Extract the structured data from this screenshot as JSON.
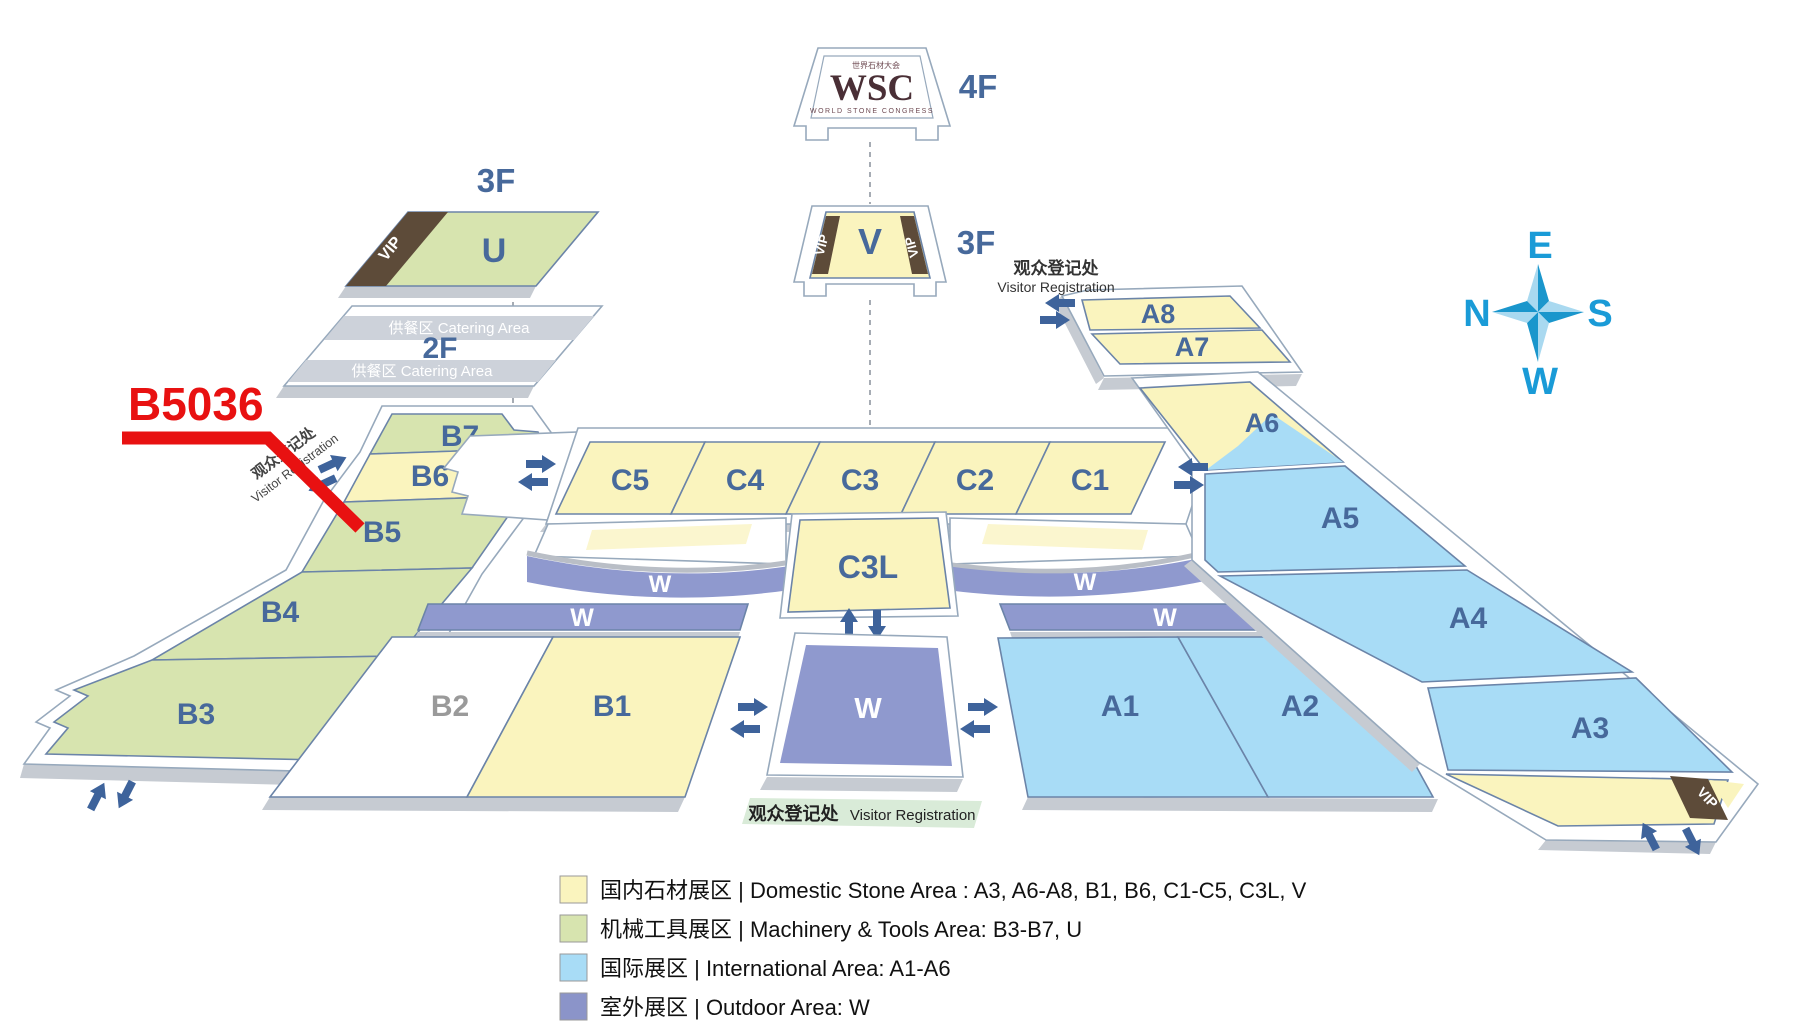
{
  "annotation": {
    "booth_label": "B5036"
  },
  "buildings": {
    "wsc": {
      "floor": "4F",
      "logo_cn": "世界石材大会",
      "logo_main": "WSC",
      "logo_sub": "WORLD STONE CONGRESS"
    },
    "v": {
      "floor": "3F"
    },
    "u": {
      "floor": "3F"
    },
    "f2": {
      "floor": "2F",
      "catering": "供餐区  Catering Area"
    }
  },
  "halls": {
    "a1": "A1",
    "a2": "A2",
    "a3": "A3",
    "a4": "A4",
    "a5": "A5",
    "a6": "A6",
    "a7": "A7",
    "a8": "A8",
    "b1": "B1",
    "b2": "B2",
    "b3": "B3",
    "b4": "B4",
    "b5": "B5",
    "b6": "B6",
    "b7": "B7",
    "c1": "C1",
    "c2": "C2",
    "c3": "C3",
    "c4": "C4",
    "c5": "C5",
    "c3l": "C3L",
    "u": "U",
    "v": "V",
    "w": "W",
    "vip": "VIP"
  },
  "registration": {
    "cn": "观众登记处",
    "en": "Visitor Registration"
  },
  "compass": {
    "top": "E",
    "left": "N",
    "right": "S",
    "bottom": "W"
  },
  "legend": {
    "items": [
      {
        "swatch": "#FAF4BE",
        "label": "国内石材展区 | Domestic Stone Area : A3, A6-A8, B1, B6, C1-C5, C3L, V"
      },
      {
        "swatch": "#D7E4AF",
        "label": "机械工具展区 | Machinery & Tools Area: B3-B7, U"
      },
      {
        "swatch": "#A8DCF6",
        "label": "国际展区 | International Area:  A1-A6"
      },
      {
        "swatch": "#8B94C9",
        "label": "室外展区 | Outdoor Area:  W"
      }
    ]
  },
  "colors": {
    "domestic_stone": "#FAF4BE",
    "machinery_tools": "#D7E4AF",
    "international": "#A8DCF6",
    "outdoor": "#8F99CE",
    "vip": "#5D4B39",
    "highlight": "#E81111",
    "compass": "#1A9BD7",
    "hall_label": "#47699B"
  }
}
